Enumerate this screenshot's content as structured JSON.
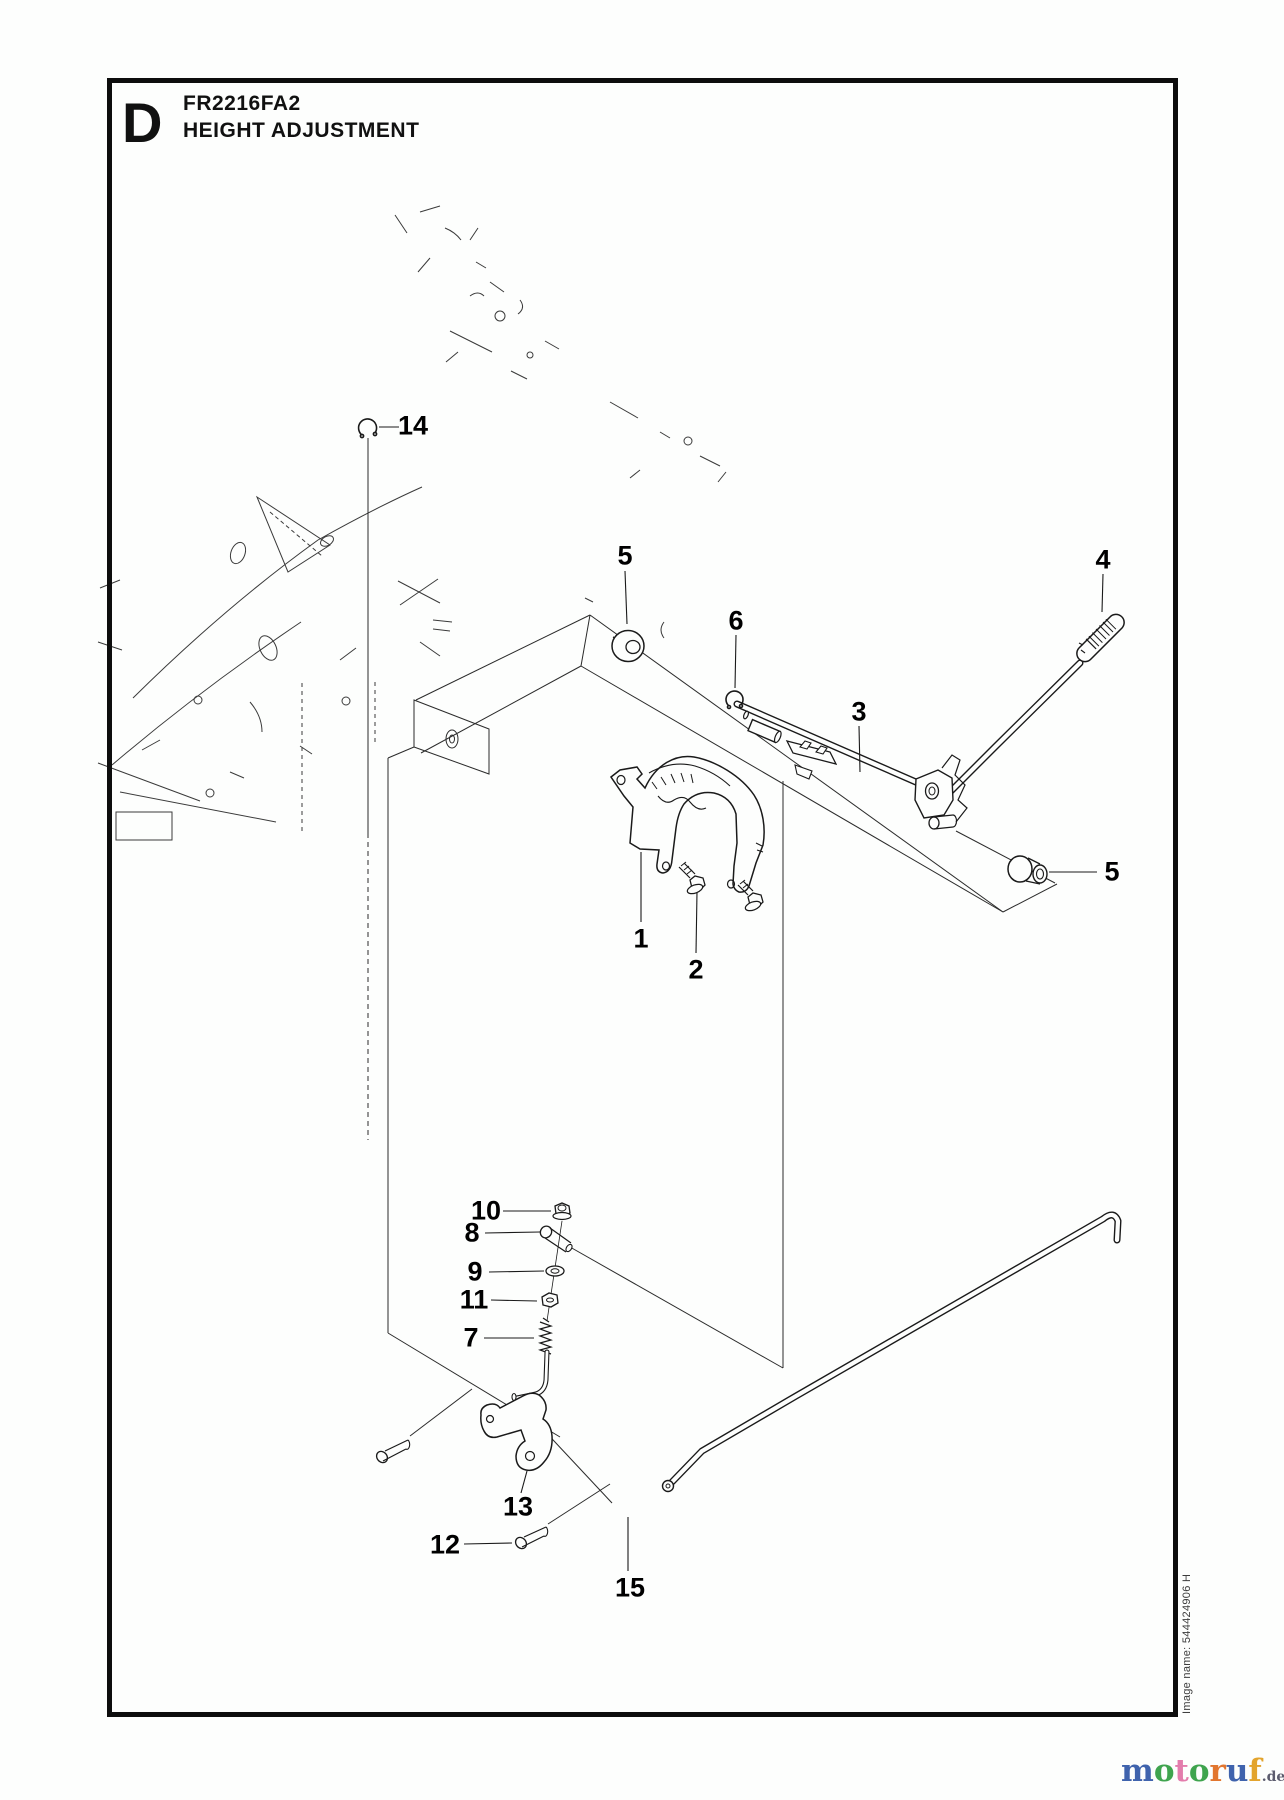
{
  "title_block": {
    "plate_letter": "D",
    "model": "FR2216FA2",
    "section": "HEIGHT ADJUSTMENT"
  },
  "side_note": "Image name: 544424906 H",
  "logo": {
    "letters": [
      {
        "ch": "m",
        "color": "#3f63ad"
      },
      {
        "ch": "o",
        "color": "#3fa44e"
      },
      {
        "ch": "t",
        "color": "#e37cac"
      },
      {
        "ch": "o",
        "color": "#3fa44e"
      },
      {
        "ch": "r",
        "color": "#e2762f"
      },
      {
        "ch": "u",
        "color": "#3f63ad"
      },
      {
        "ch": "f",
        "color": "#e3a42d"
      }
    ],
    "suffix": ".de",
    "suffix_color": "#5c5c6e"
  },
  "callouts": [
    {
      "n": "14",
      "x": 413,
      "y": 426
    },
    {
      "n": "5",
      "x": 625,
      "y": 556
    },
    {
      "n": "6",
      "x": 736,
      "y": 621
    },
    {
      "n": "3",
      "x": 859,
      "y": 712
    },
    {
      "n": "4",
      "x": 1103,
      "y": 560
    },
    {
      "n": "5",
      "x": 1112,
      "y": 872
    },
    {
      "n": "1",
      "x": 641,
      "y": 939
    },
    {
      "n": "2",
      "x": 696,
      "y": 970
    },
    {
      "n": "10",
      "x": 486,
      "y": 1211
    },
    {
      "n": "8",
      "x": 472,
      "y": 1233
    },
    {
      "n": "9",
      "x": 475,
      "y": 1272
    },
    {
      "n": "11",
      "x": 474,
      "y": 1300
    },
    {
      "n": "7",
      "x": 471,
      "y": 1338
    },
    {
      "n": "13",
      "x": 518,
      "y": 1507
    },
    {
      "n": "12",
      "x": 445,
      "y": 1545
    },
    {
      "n": "15",
      "x": 630,
      "y": 1588
    }
  ]
}
